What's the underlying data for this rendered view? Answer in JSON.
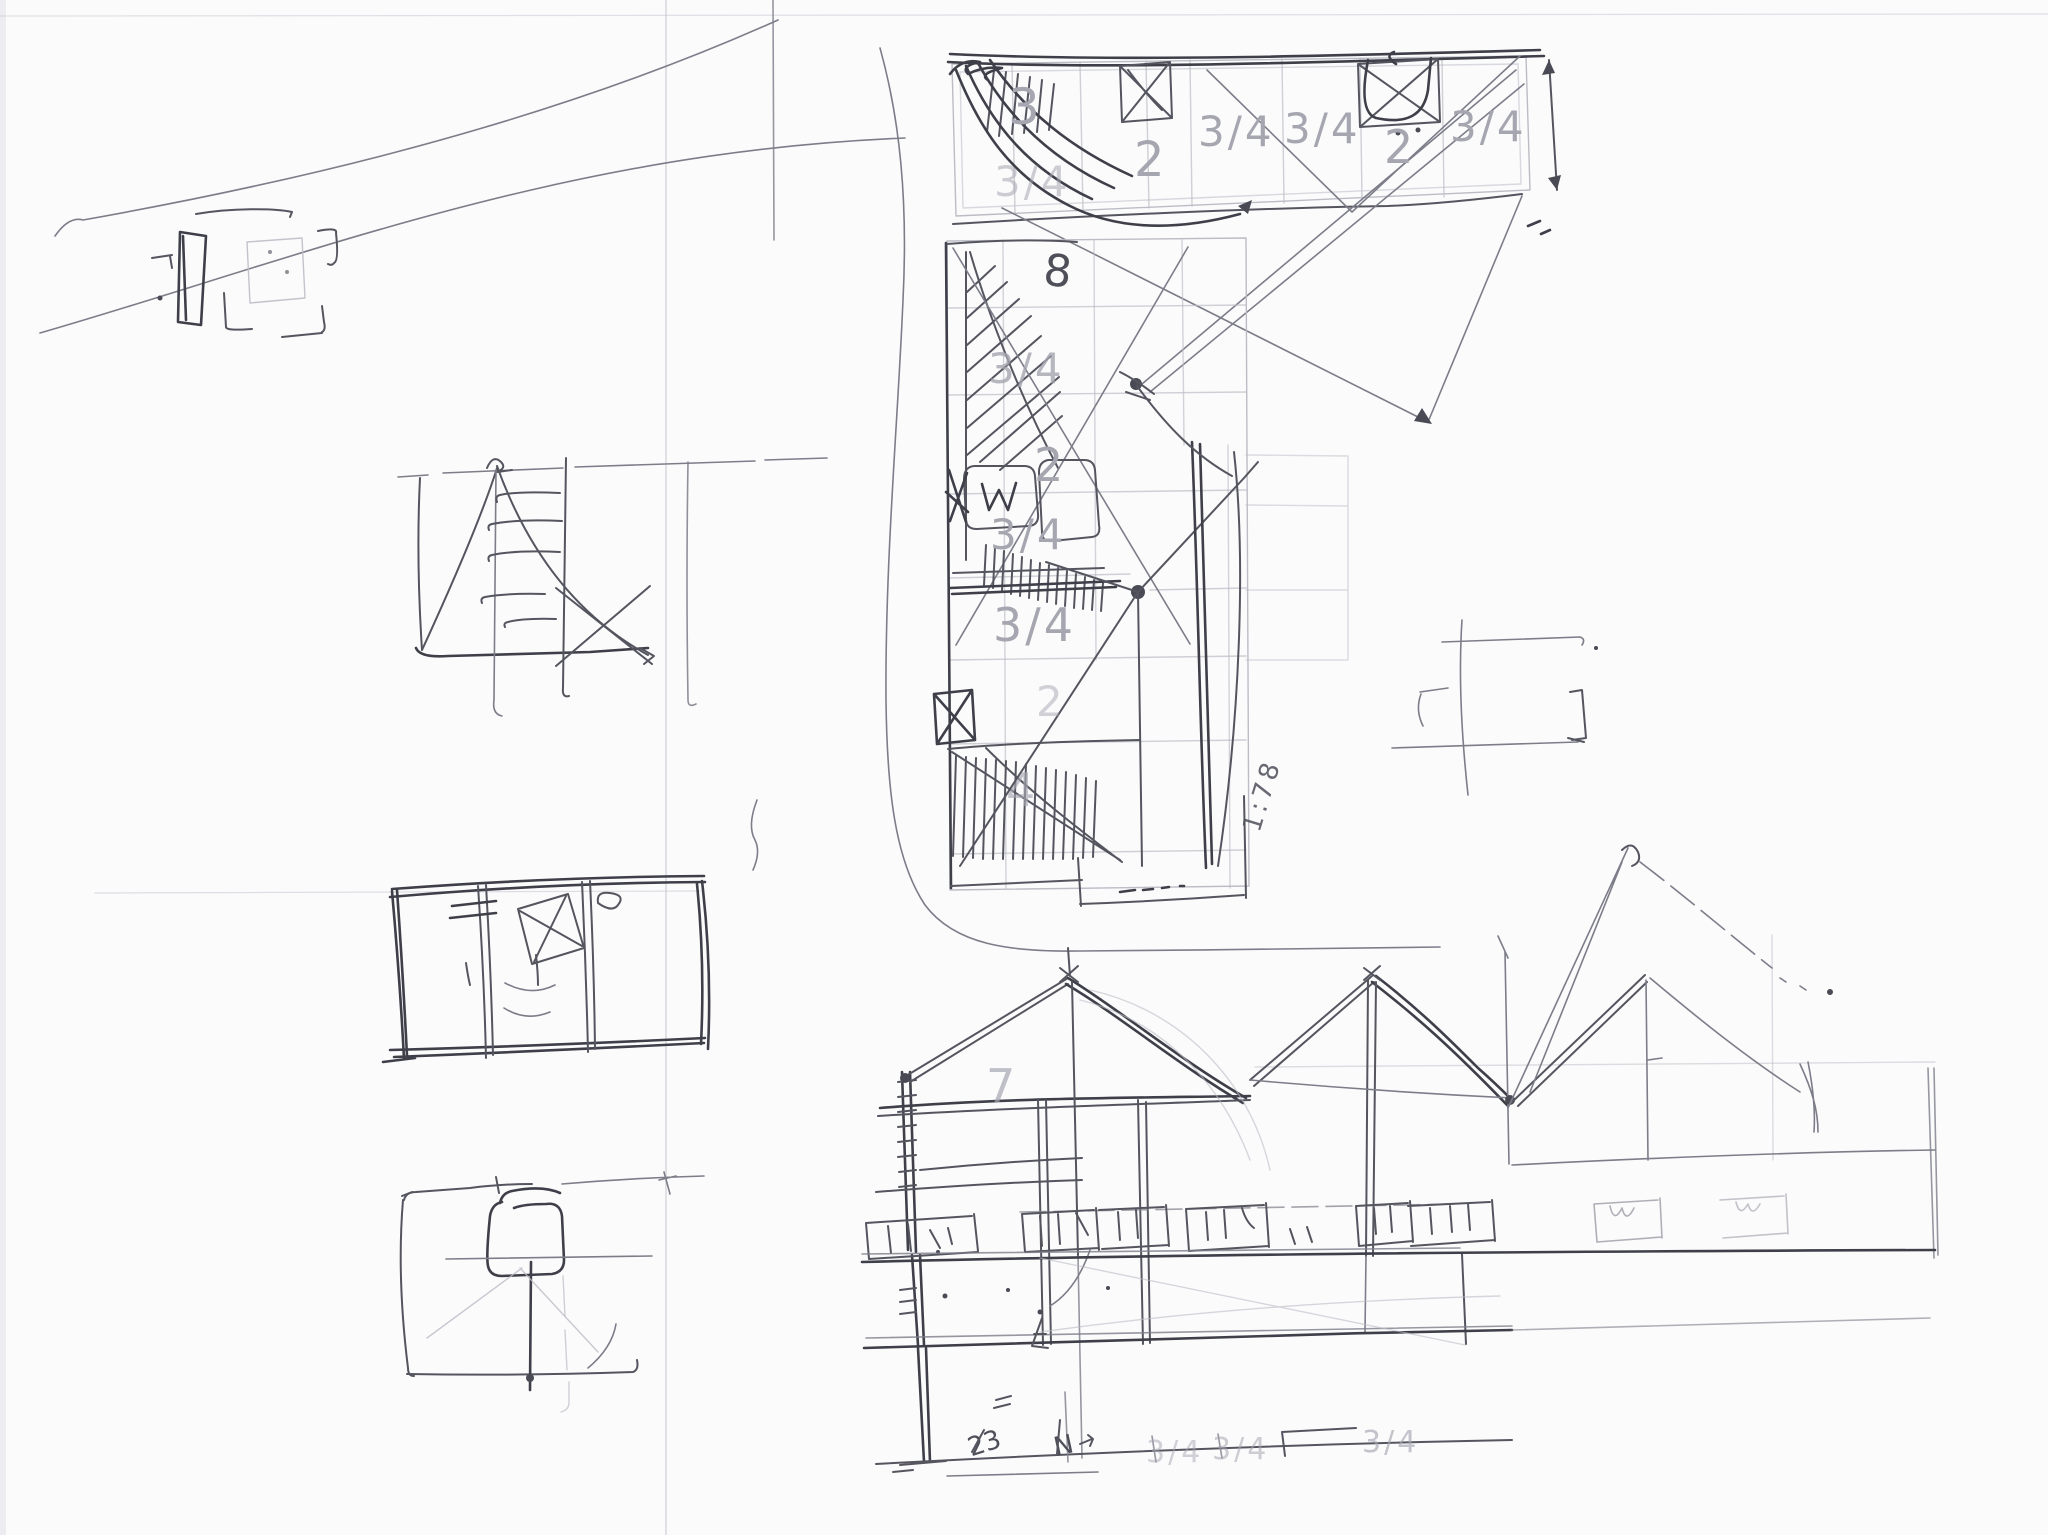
{
  "sketch": {
    "colors": {
      "paper": "#fbfbfc",
      "pen": "#55555f",
      "pen_dark": "#3f3f4a",
      "pencil_guide": "#bcbcc6",
      "ghost_print": "#a6a6b1"
    },
    "top_plan": {
      "bay_labels": [
        "3",
        "3/4",
        "2",
        "3/4",
        "3/4",
        "2",
        "3/4"
      ]
    },
    "mid_plan": {
      "room_labels": [
        "3/4",
        "2",
        "3/4",
        "3/4",
        "2",
        "4"
      ],
      "dim_label": "8",
      "scale_label": "1:78"
    },
    "elevation": {
      "level_label": "7",
      "baseline_labels": [
        "3/4",
        "3/4",
        "3/4"
      ],
      "handwritten": [
        "23",
        "N"
      ]
    }
  }
}
